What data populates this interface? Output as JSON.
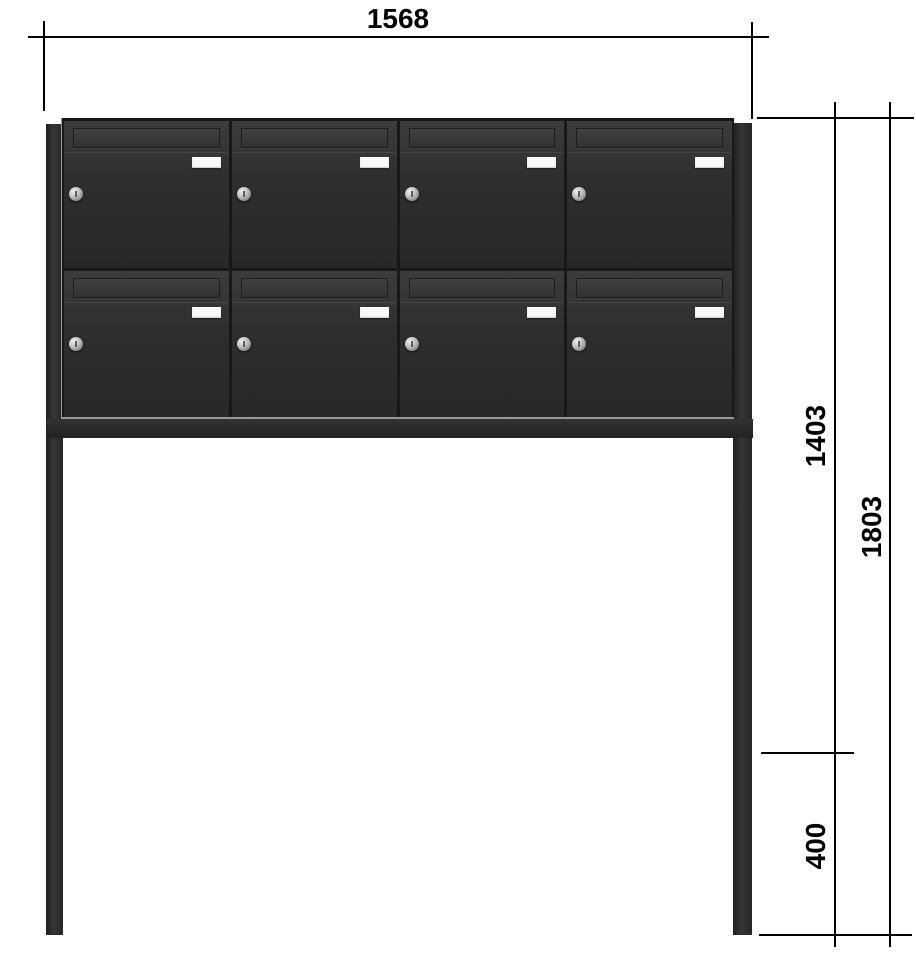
{
  "dimensions": {
    "width": "1568",
    "upper_height": "1403",
    "total_height": "1803",
    "lower_height": "400"
  },
  "unit": {
    "rows": 2,
    "columns": 4,
    "box_count": 8
  },
  "colors": {
    "body_anthracite": "#2d2d2d",
    "dimension_line": "#000000",
    "nameplate_white": "#f7f7f7",
    "lock_silver": "#b5b5b5",
    "background": "#ffffff"
  }
}
